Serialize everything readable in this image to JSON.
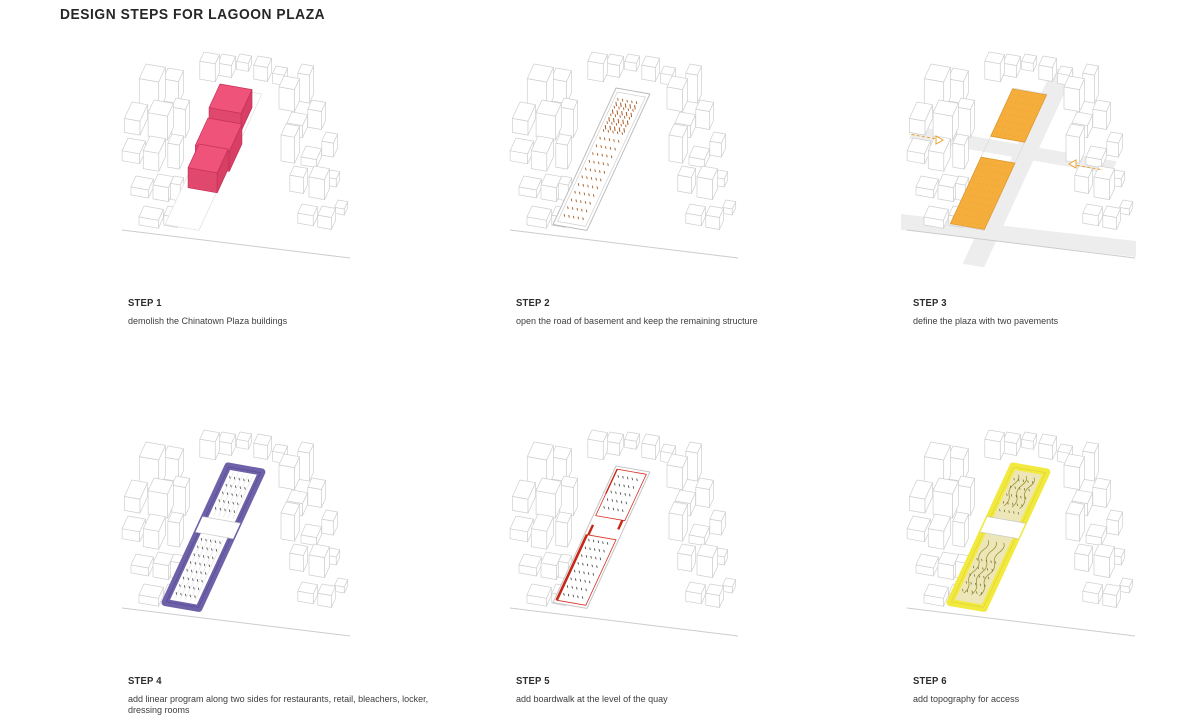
{
  "title": "DESIGN STEPS FOR LAGOON PLAZA",
  "steps": [
    {
      "label": "STEP 1",
      "caption": "demolish the Chinatown Plaza buildings",
      "type": "demolish",
      "color": "#ef5379",
      "color_front": "#e0486d",
      "color_side": "#d73f64"
    },
    {
      "label": "STEP 2",
      "caption": "open the road of basement and keep the remaining structure",
      "type": "structure",
      "color": "#a85a22"
    },
    {
      "label": "STEP 3",
      "caption": "define the plaza with two pavements",
      "type": "pavements",
      "color": "#f5ad3c",
      "edge_color": "#dd9a2e",
      "arrow_color": "#eda22f",
      "hatch_color": "#e8a133"
    },
    {
      "label": "STEP 4",
      "caption": "add linear program along two sides for restaurants, retail, bleachers, locker, dressing rooms",
      "type": "program",
      "color": "#6f61a8",
      "edge_color": "#544795",
      "tick_color": "#4a4a4a"
    },
    {
      "label": "STEP 5",
      "caption": "add boardwalk at the level of the quay",
      "type": "boardwalk",
      "color": "#d93125",
      "color_dark": "#c62817",
      "tick_color": "#3f3f3f"
    },
    {
      "label": "STEP 6",
      "caption": "add topography for access",
      "type": "topography",
      "color": "#f2e93e",
      "edge_color": "#d8cd2f",
      "interior": "#ece6b8",
      "contour_color": "#9d9434",
      "tick_color": "#6f682b"
    }
  ],
  "palette": {
    "wireframe": "#cfcfcf",
    "shoreline": "#cccccc",
    "road": "#ededed",
    "plot_outline": "#c6c6c6",
    "band_edge": "#c9c9c9"
  }
}
